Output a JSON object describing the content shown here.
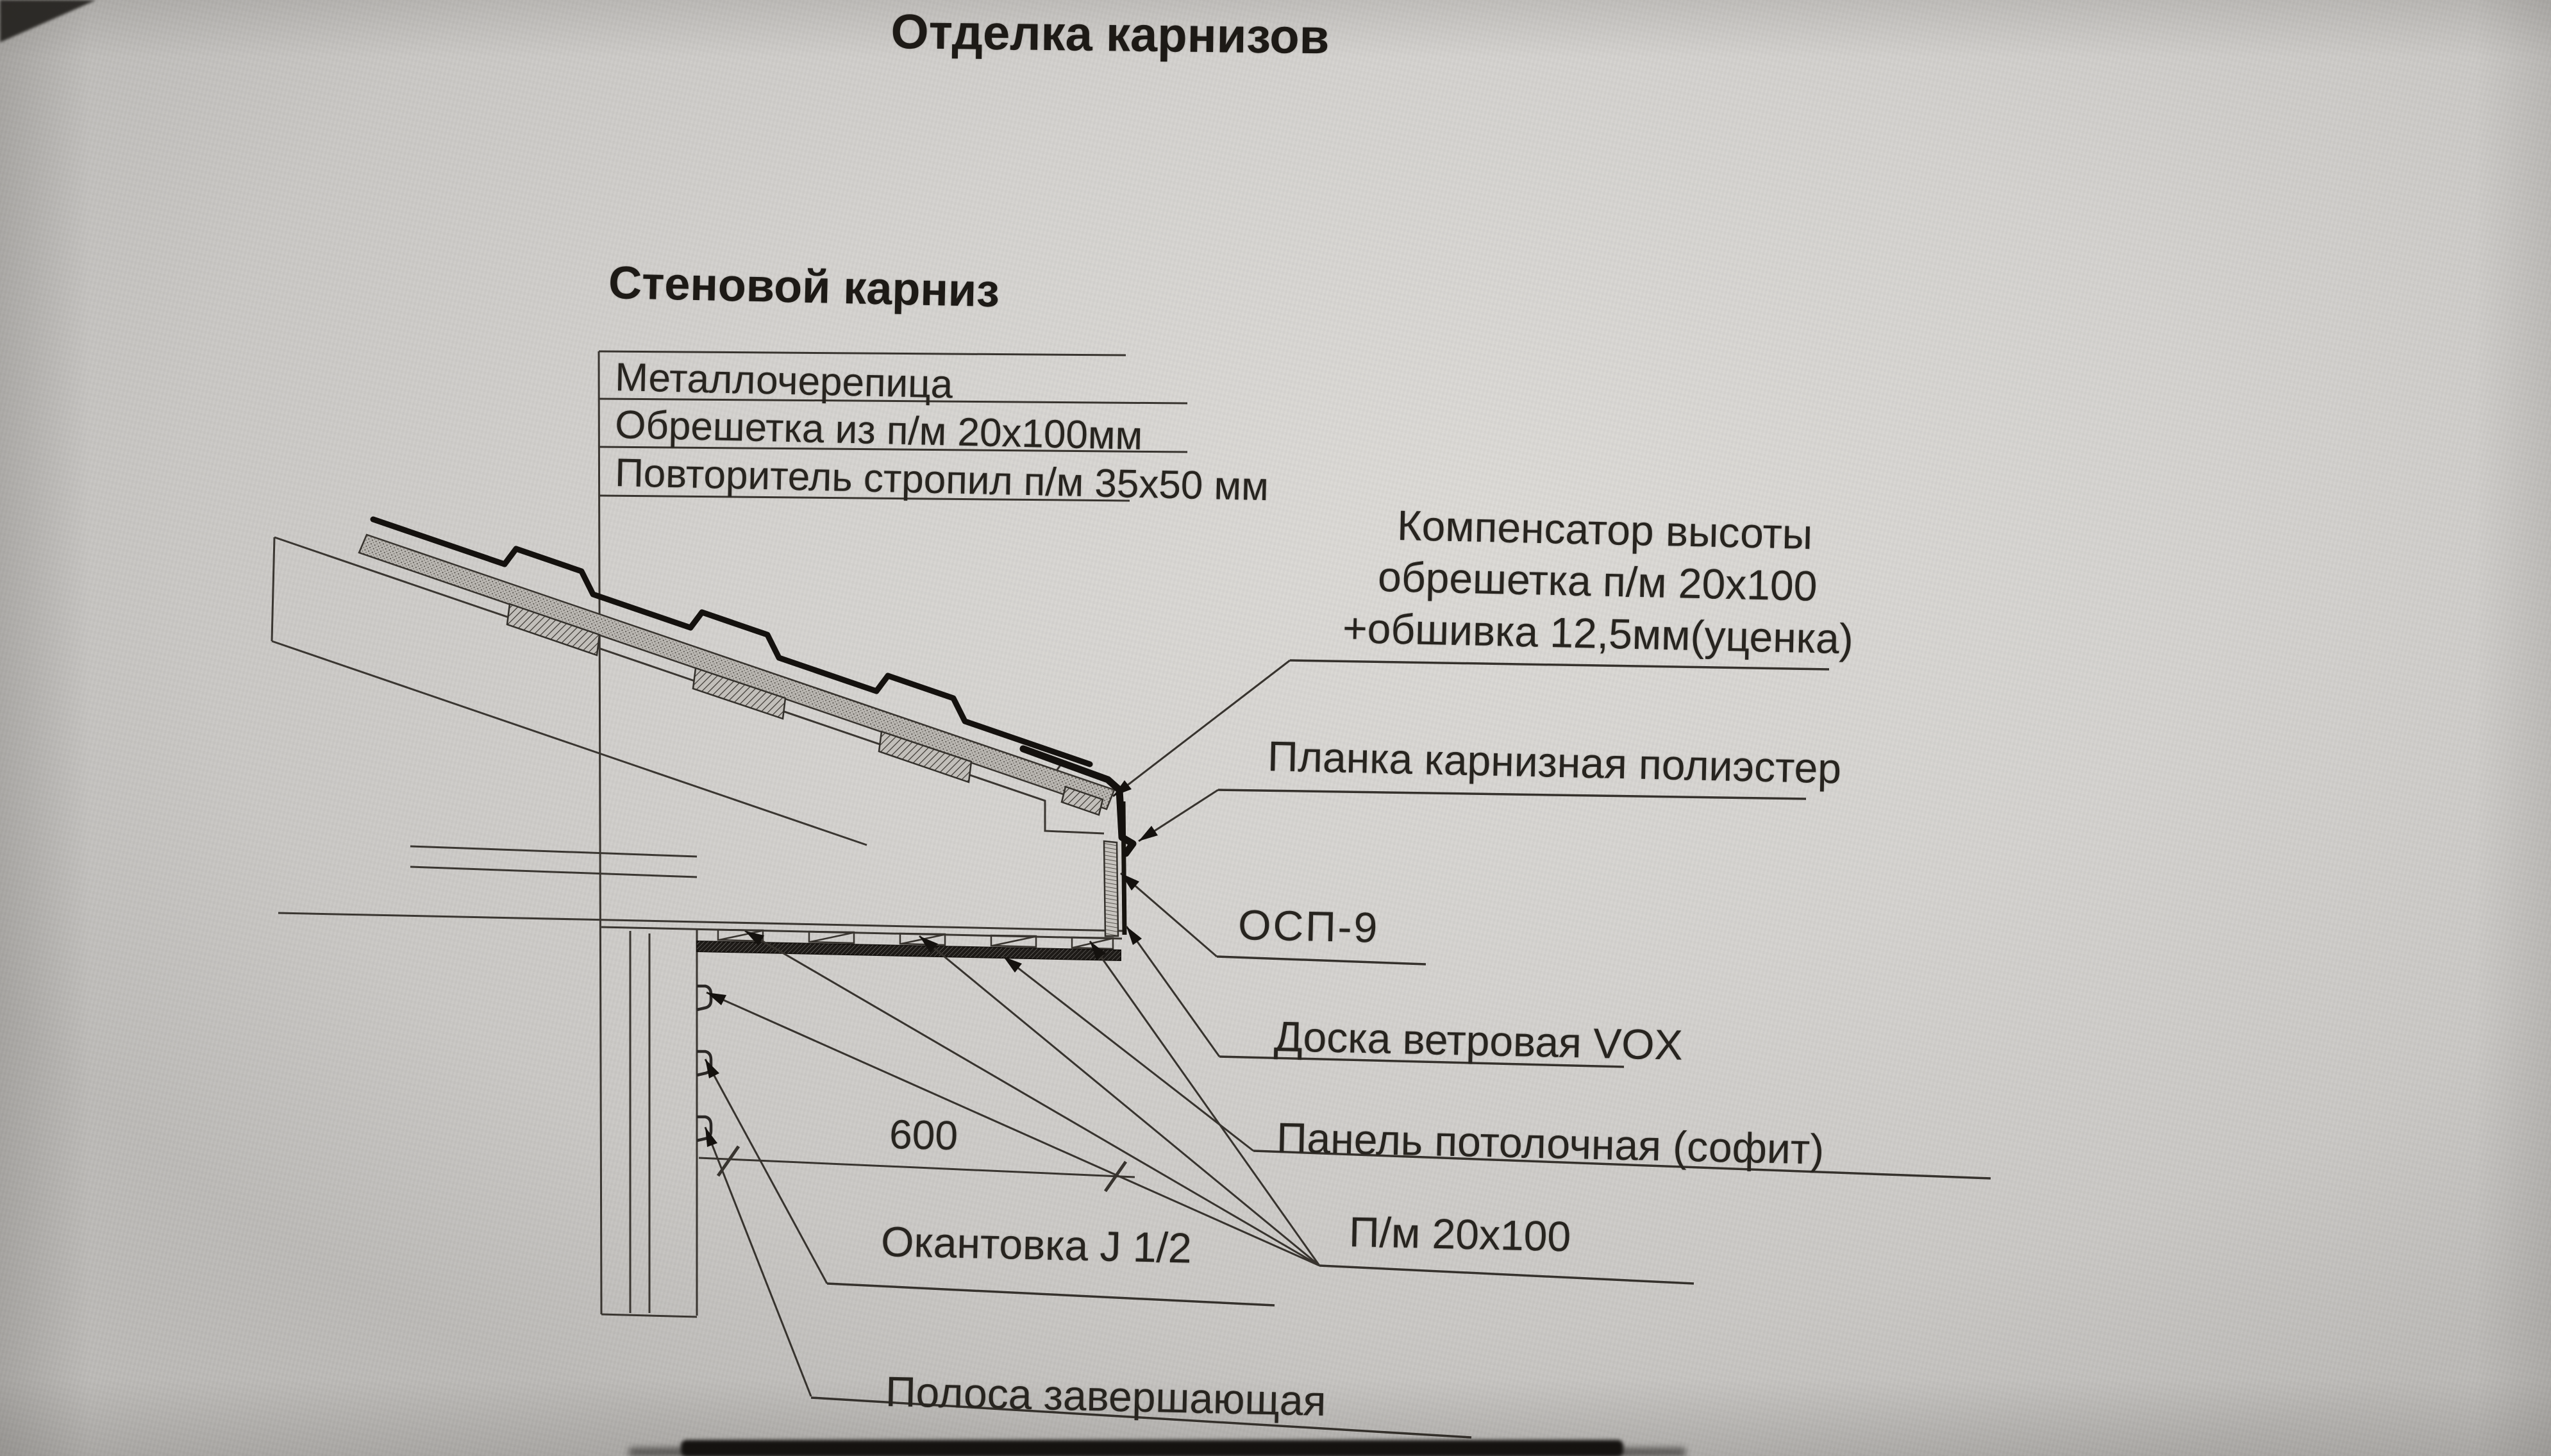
{
  "page": {
    "title": "Отделка карнизов",
    "subtitle": "Стеновой карниз"
  },
  "material_stack": {
    "rows": [
      "Металлочерепица",
      "Обрешетка из п/м 20х100мм",
      "Повторитель стропил п/м 35х50 мм"
    ]
  },
  "callouts": {
    "compensator": {
      "line1": "Компенсатор высоты",
      "line2": "обрешетка п/м 20х100",
      "line3": "+обшивка 12,5мм(уценка)"
    },
    "eaves_strip": "Планка карнизная полиэстер",
    "osb": "ОСП-9",
    "wind_board": "Доска ветровая VOX",
    "soffit_panel": "Панель потолочная (софит)",
    "lumber": "П/м 20х100",
    "j_trim": "Окантовка J 1/2",
    "finishing_strip": "Полоса завершающая"
  },
  "dimension": {
    "soffit_width_mm": "600"
  },
  "colors": {
    "paper": "#d3d1ce",
    "ink": "#35322e",
    "ink_heavy": "#15120f"
  }
}
